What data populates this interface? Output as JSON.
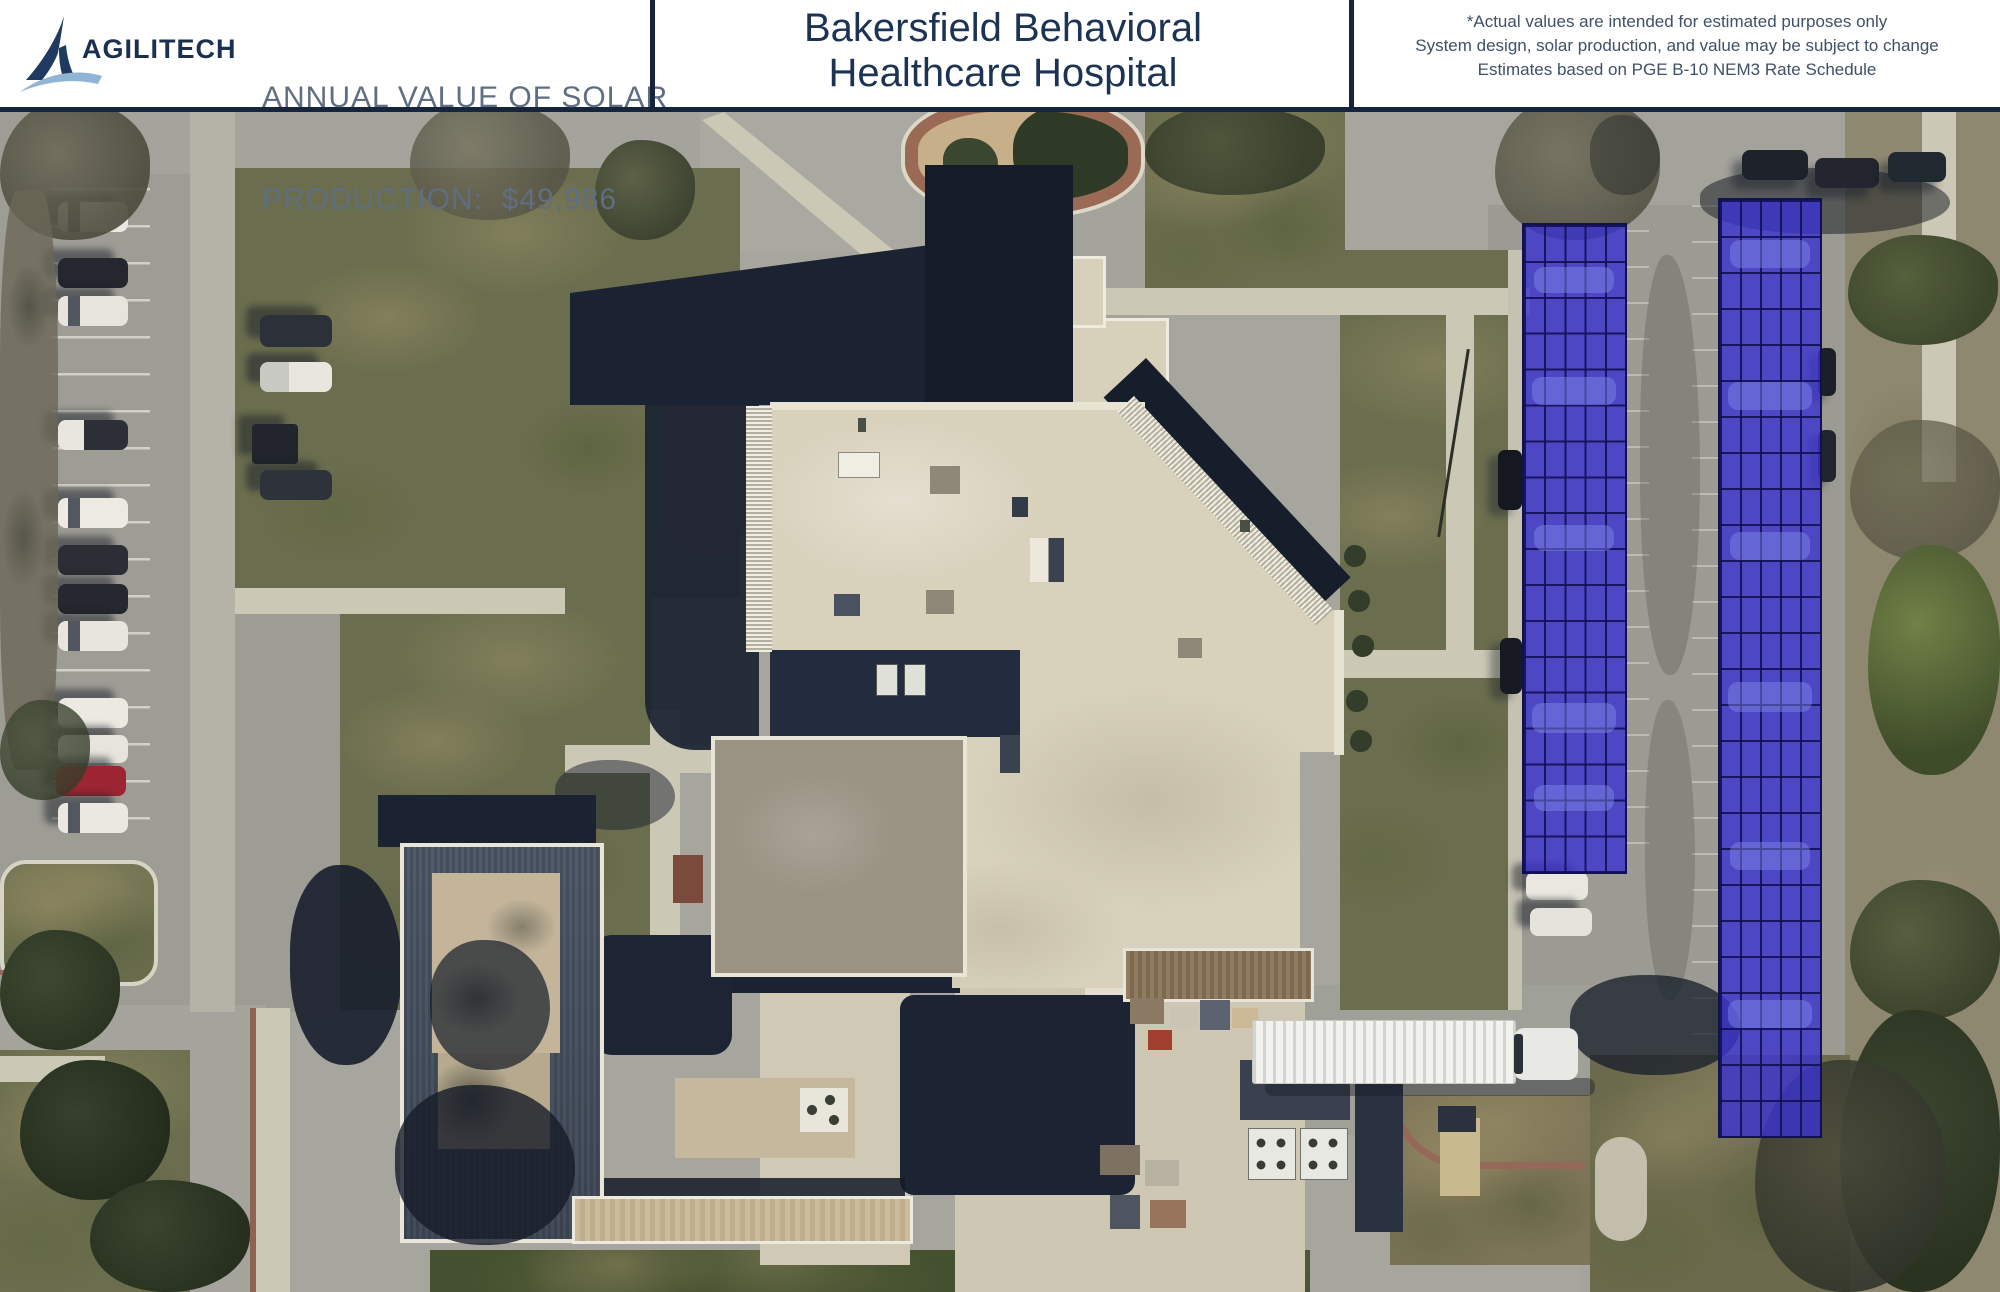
{
  "page": {
    "type": "solar-proposal-aerial",
    "description": "Aerial satellite view of hospital campus with two proposed blue solar carport arrays over the east parking lot"
  },
  "header": {
    "logo": {
      "brand": "AGILITECH"
    },
    "production": {
      "line1": "ANNUAL VALUE OF SOLAR",
      "line2": "PRODUCTION:  $49,986",
      "annual_value": "$49,986"
    },
    "title": {
      "line1": "Bakersfield Behavioral",
      "line2": "Healthcare Hospital"
    },
    "disclaimer": {
      "line1": "*Actual values are intended for estimated purposes only",
      "line2": "System design, solar production, and value may be subject to change",
      "line3": "Estimates based on PGE B-10 NEM3 Rate Schedule"
    }
  },
  "solar": {
    "array_fill": "#3932CF",
    "array_grid": "#141150",
    "arrays": [
      {
        "name": "West carport array",
        "columns": 5,
        "rows": 18
      },
      {
        "name": "East carport array",
        "columns": 5,
        "rows": 26
      }
    ]
  },
  "colors": {
    "brand_navy": "#1E3A5F",
    "logo_swoosh": "#8FB4D4",
    "header_border": "#16243C",
    "title_text": "#1D3354",
    "production_text": "#5F6E80",
    "disclaimer_text": "#3F5068"
  }
}
